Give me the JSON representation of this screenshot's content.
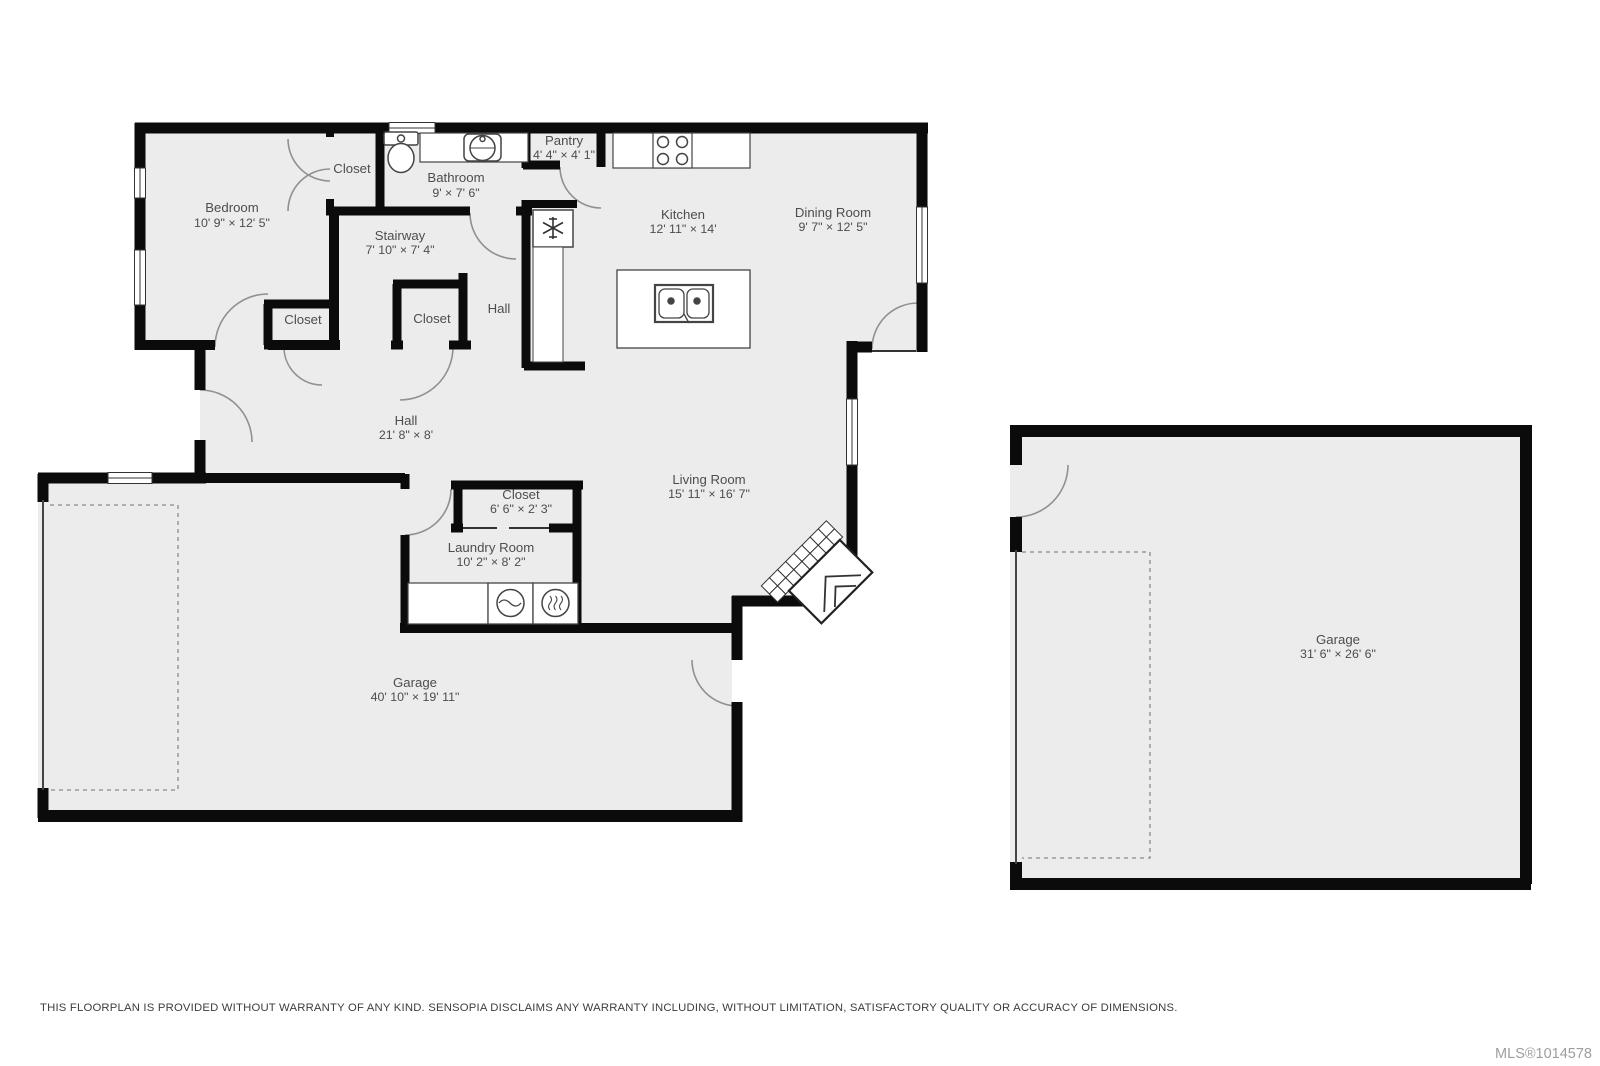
{
  "rooms": {
    "bedroom": {
      "label": "Bedroom",
      "dims": "10' 9\" × 12' 5\""
    },
    "closet_bedroom": {
      "label": "Closet"
    },
    "bathroom": {
      "label": "Bathroom",
      "dims": "9' × 7' 6\""
    },
    "pantry": {
      "label": "Pantry",
      "dims": "4' 4\" × 4' 1\""
    },
    "kitchen": {
      "label": "Kitchen",
      "dims": "12' 11\" × 14'"
    },
    "dining": {
      "label": "Dining Room",
      "dims": "9' 7\" × 12' 5\""
    },
    "stairway": {
      "label": "Stairway",
      "dims": "7' 10\" × 7' 4\""
    },
    "closet_left": {
      "label": "Closet"
    },
    "closet_mid": {
      "label": "Closet"
    },
    "hall_upper": {
      "label": "Hall"
    },
    "hall_main": {
      "label": "Hall",
      "dims": "21' 8\" × 8'"
    },
    "closet_laundry": {
      "label": "Closet",
      "dims": "6' 6\" × 2' 3\""
    },
    "laundry": {
      "label": "Laundry Room",
      "dims": "10' 2\" × 8' 2\""
    },
    "living": {
      "label": "Living Room",
      "dims": "15' 11\" × 16' 7\""
    },
    "garage_main": {
      "label": "Garage",
      "dims": "40' 10\" × 19' 11\""
    },
    "garage_detached": {
      "label": "Garage",
      "dims": "31' 6\" × 26' 6\""
    }
  },
  "fixtures": [
    "toilet",
    "bathroom-sink",
    "stove",
    "refrigerator",
    "island-sink",
    "washer",
    "dryer",
    "fireplace"
  ],
  "footer": {
    "disclaimer": "THIS FLOORPLAN IS PROVIDED WITHOUT WARRANTY OF ANY KIND. SENSOPIA DISCLAIMS ANY WARRANTY INCLUDING, WITHOUT LIMITATION, SATISFACTORY QUALITY OR ACCURACY OF DIMENSIONS.",
    "mls": "MLS®1014578"
  },
  "colors": {
    "floor": "#ececec",
    "wall": "#0b0b0b",
    "door_arc": "#909090",
    "label_text": "#4d4d4d",
    "mls_text": "#9e9e9e"
  }
}
